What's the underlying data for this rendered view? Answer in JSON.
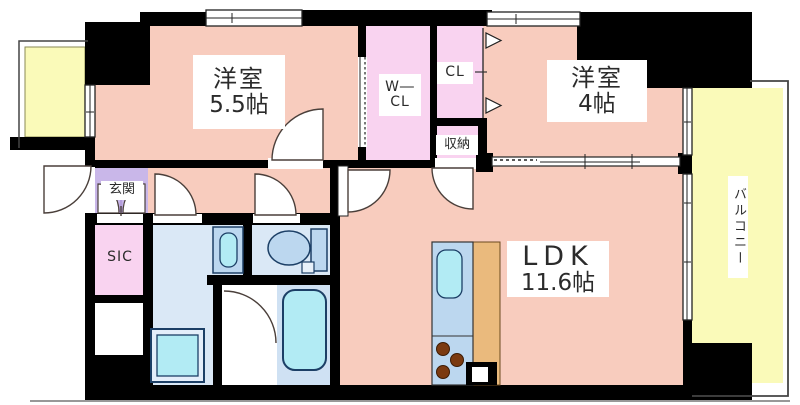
{
  "rooms": {
    "bedroom1": {
      "name": "洋室",
      "size": "5.5帖"
    },
    "bedroom2": {
      "name": "洋室",
      "size": "4帖"
    },
    "ldk": {
      "name": "LDK",
      "size": "11.6帖"
    },
    "walk_in_closet": {
      "line1": "W―",
      "line2": "CL"
    },
    "closet": {
      "label": "CL"
    },
    "storage": {
      "label": "収納"
    },
    "entrance": {
      "label": "玄関"
    },
    "shoes_closet": {
      "label": "SIC"
    },
    "balcony": {
      "label": "バルコニー"
    }
  },
  "colors": {
    "wall": "#000000",
    "room_floor": "#f8ccbe",
    "closet_floor": "#f9d3f0",
    "entrance_floor": "#c9b7e9",
    "entrance_fan": "#b49ddc",
    "balcony_floor": "#fafab9",
    "wet_area_floor": "#dae8f6",
    "bath_floor": "#cfe1f3",
    "fixture_blue": "#bcd7ef",
    "fixture_cyan": "#b2ebf4",
    "kitchen_counter_wood": "#eaba7d",
    "burner_brown": "#7b3a10",
    "label_text": "#2b2b2b"
  }
}
